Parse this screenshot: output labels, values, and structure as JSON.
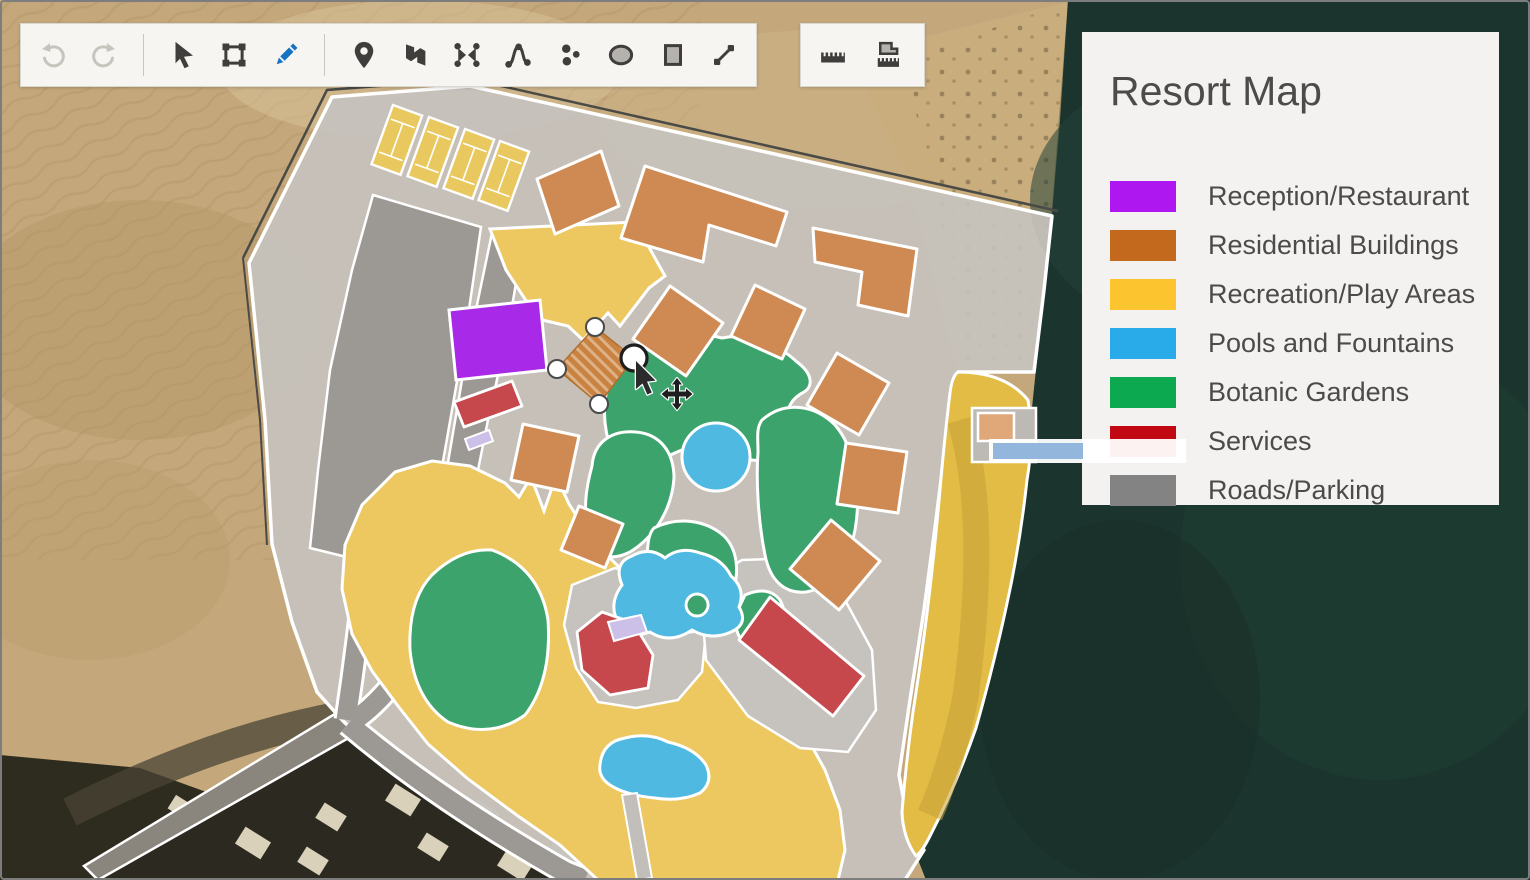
{
  "legend": {
    "title": "Resort Map",
    "items": [
      {
        "label": "Reception/Restaurant",
        "color": "#AE17F0"
      },
      {
        "label": "Residential Buildings",
        "color": "#C2691D"
      },
      {
        "label": "Recreation/Play Areas",
        "color": "#FCC42F"
      },
      {
        "label": "Pools and Fountains",
        "color": "#29ABE9"
      },
      {
        "label": "Botanic Gardens",
        "color": "#0DA951"
      },
      {
        "label": "Services",
        "color": "#C20812"
      },
      {
        "label": "Roads/Parking",
        "color": "#838383"
      }
    ]
  },
  "toolbar_main": {
    "tools": [
      {
        "id": "undo",
        "icon": "undo-icon",
        "state": "disabled"
      },
      {
        "id": "redo",
        "icon": "redo-icon",
        "state": "disabled"
      },
      {
        "id": "select",
        "icon": "cursor-icon",
        "state": "normal"
      },
      {
        "id": "transform",
        "icon": "transform-icon",
        "state": "normal"
      },
      {
        "id": "draw",
        "icon": "pencil-icon",
        "state": "active"
      },
      {
        "id": "add-marker",
        "icon": "marker-icon",
        "state": "normal"
      },
      {
        "id": "add-polygon",
        "icon": "polygon-icon",
        "state": "normal"
      },
      {
        "id": "edit-vertices",
        "icon": "vertices-icon",
        "state": "normal"
      },
      {
        "id": "add-path",
        "icon": "path-icon",
        "state": "normal"
      },
      {
        "id": "add-points",
        "icon": "points-icon",
        "state": "normal"
      },
      {
        "id": "draw-ellipse",
        "icon": "ellipse-icon",
        "state": "normal"
      },
      {
        "id": "draw-rectangle",
        "icon": "rectangle-icon",
        "state": "normal"
      },
      {
        "id": "draw-line",
        "icon": "line-icon",
        "state": "normal"
      }
    ]
  },
  "toolbar_measure": {
    "tools": [
      {
        "id": "measure-distance",
        "icon": "ruler-icon"
      },
      {
        "id": "measure-area",
        "icon": "area-ruler-icon"
      }
    ]
  },
  "map": {
    "selection": {
      "shape": "residential-building",
      "handle_count": 4,
      "mode": "move"
    }
  },
  "colors": {
    "accent_active_tool": "#1673C4",
    "toolbar_bg": "#F7F5F1",
    "legend_bg": "#F4F2F0",
    "text": "#4B4B49",
    "site_overlay": "#C6C2BE",
    "roads_parking_fill": "#9C9894",
    "residential_fill": "#CE8A52",
    "recreation_fill": "#EDC75F",
    "beach_fill": "#E2BC45",
    "garden_fill": "#3CA36C",
    "pool_fill": "#4FB9E2",
    "services_fill": "#C6484C",
    "reception_fill": "#A82AE8",
    "water": "#1B342D",
    "desert": "#C4A87B",
    "pier": "#92B6DC"
  }
}
